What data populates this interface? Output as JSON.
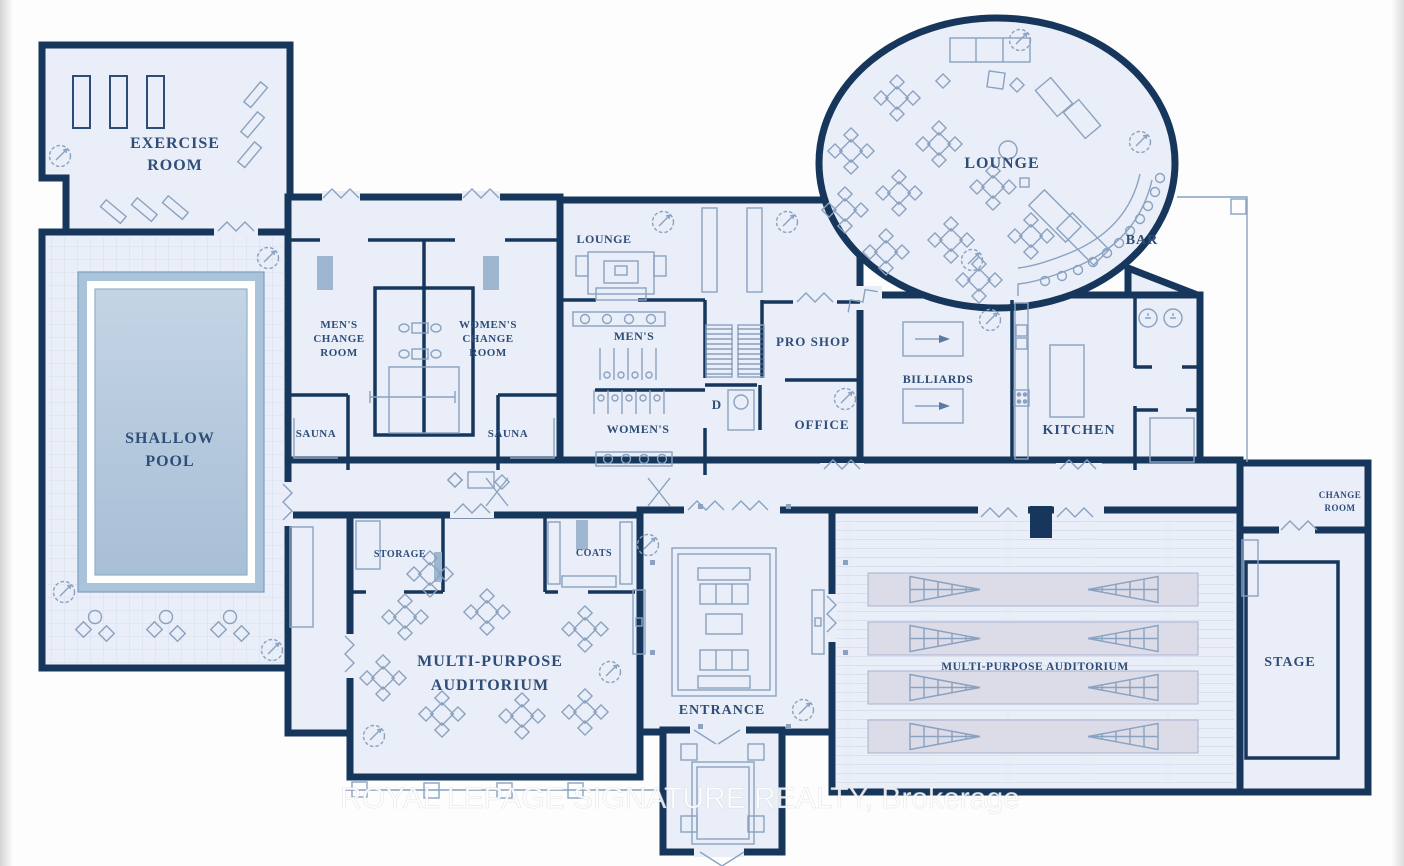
{
  "watermark": "ROYAL LEPAGE SIGNATURE REALTY, Brokerage",
  "rooms": {
    "exercise_room": {
      "lines": [
        "EXERCISE",
        "ROOM"
      ]
    },
    "shallow_pool": {
      "lines": [
        "SHALLOW",
        "POOL"
      ]
    },
    "mens_change_room": {
      "lines": [
        "MEN'S",
        "CHANGE",
        "ROOM"
      ]
    },
    "womens_change_room": {
      "lines": [
        "WOMEN'S",
        "CHANGE",
        "ROOM"
      ]
    },
    "sauna_left": {
      "lines": [
        "SAUNA"
      ]
    },
    "sauna_right": {
      "lines": [
        "SAUNA"
      ]
    },
    "lounge_small": {
      "lines": [
        "LOUNGE"
      ]
    },
    "mens_washroom": {
      "lines": [
        "MEN'S"
      ]
    },
    "womens_washroom": {
      "lines": [
        "WOMEN'S"
      ]
    },
    "pro_shop": {
      "lines": [
        "PRO SHOP"
      ]
    },
    "office": {
      "lines": [
        "OFFICE"
      ]
    },
    "d_room": {
      "lines": [
        "D"
      ]
    },
    "billiards": {
      "lines": [
        "BILLIARDS"
      ]
    },
    "lounge_main": {
      "lines": [
        "LOUNGE"
      ]
    },
    "bar": {
      "lines": [
        "BAR"
      ]
    },
    "kitchen": {
      "lines": [
        "KITCHEN"
      ]
    },
    "storage": {
      "lines": [
        "STORAGE"
      ]
    },
    "coats": {
      "lines": [
        "COATS"
      ]
    },
    "auditorium_left": {
      "lines": [
        "MULTI-PURPOSE",
        "AUDITORIUM"
      ]
    },
    "entrance": {
      "lines": [
        "ENTRANCE"
      ]
    },
    "auditorium_right": {
      "lines": [
        "MULTI-PURPOSE AUDITORIUM"
      ]
    },
    "stage": {
      "lines": [
        "STAGE"
      ]
    },
    "stage_change_room": {
      "lines": [
        "CHANGE",
        "ROOM"
      ]
    }
  },
  "icons": {
    "tree-icon": "scalloped circle with needle",
    "ceiling-fan-icon": "circle with diagonal needle",
    "door-swing-icon": "zigzag break in wall",
    "bar-stool-icon": "small circle",
    "table-cluster-icon": "diamond table with four diamond chairs"
  },
  "colors": {
    "wall": "#16365c",
    "floor": "#e9eef8",
    "pool_water": "#afc7dc",
    "pool_border": "#a9c4da",
    "furniture_line": "#8aa2c0",
    "label_text": "#2e4d78",
    "seat_band": "#dcdce9",
    "shading": "#9fb6d1",
    "watermark_color": "#ffffff"
  }
}
